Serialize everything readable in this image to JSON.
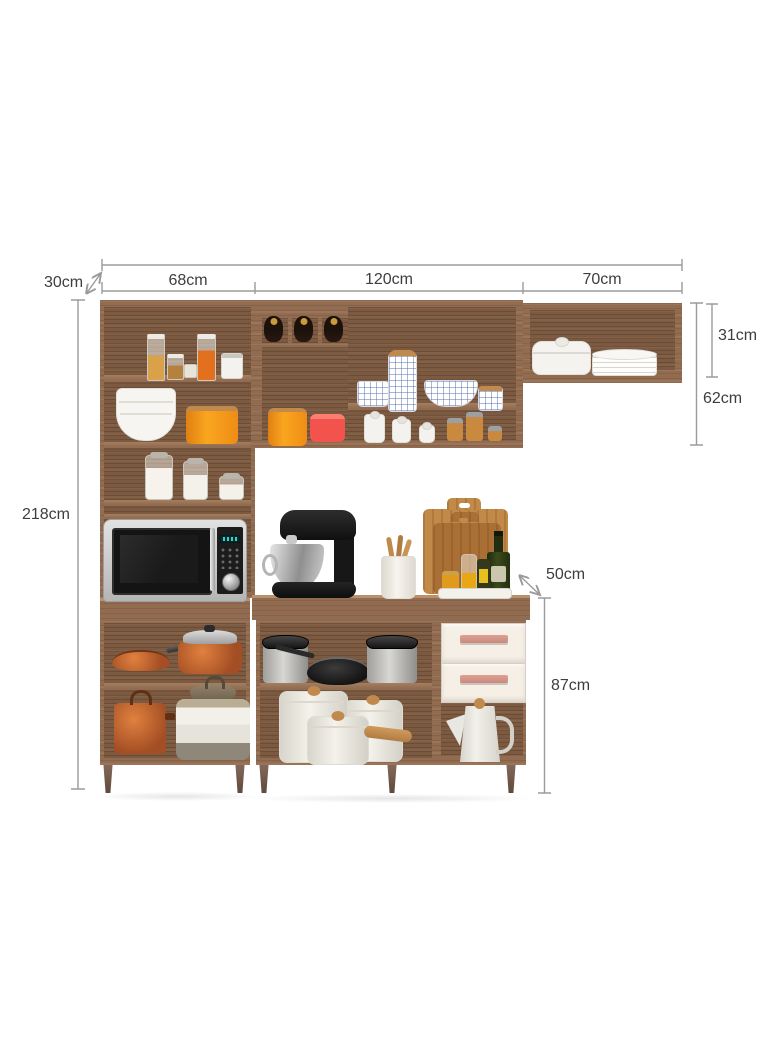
{
  "title": "Kitchen cabinet set with dimensions",
  "dimensions": {
    "total_width": "258cm",
    "left_section_width": "68cm",
    "middle_section_width": "120cm",
    "right_section_width": "70cm",
    "upper_cabinet_depth": "30cm",
    "total_height": "218cm",
    "right_upper_cabinet_height": "31cm",
    "middle_upper_cabinet_height": "62cm",
    "base_cabinet_depth": "50cm",
    "base_cabinet_height": "87cm"
  },
  "colors": {
    "wood": "#916c51",
    "wood_dark": "#7b5a41",
    "wood_light": "#a67e5f",
    "wood_accent": "#c08a4f",
    "cream": "#f5efe6",
    "drawer_handle": "#c9887d",
    "dim_line": "#9b9b9b",
    "dim_text": "#3e3e3e",
    "orange": "#f59a1f",
    "red_pink": "#f2544d",
    "copper": "#b65c33",
    "appliance_black": "#1d1d1d",
    "teal_display": "#2fd3c8",
    "oil_yellow": "#e8a816",
    "bottle_green": "#2c3a16"
  },
  "scene": {
    "items": [
      "pantry-containers",
      "white-tin",
      "bowl-stack",
      "orange-canister",
      "storage-jars",
      "wine-rack-with-bottles",
      "pink-canister",
      "plaid-creamer",
      "plaid-bottle",
      "plaid-bowl",
      "plaid-jar",
      "white-jars",
      "spice-jars",
      "casserole-dish",
      "plate-stack",
      "microwave",
      "stand-mixer",
      "utensil-crock",
      "cutting-boards",
      "oil-and-vinegar-set",
      "copper-frying-pan",
      "copper-casserole",
      "copper-pot",
      "striped-stockpot",
      "stainless-pots",
      "black-frying-pan",
      "white-cookware-set",
      "coffee-pot",
      "drawers"
    ]
  }
}
